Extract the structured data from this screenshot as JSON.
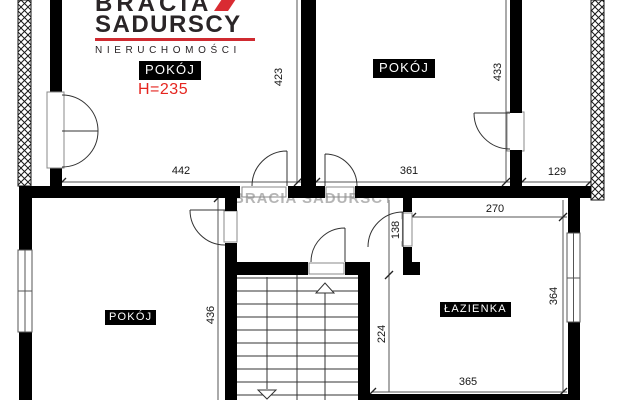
{
  "logo": {
    "line1": "BRACIA",
    "line2": "SADURSCY",
    "line3": "NIERUCHOMOŚCI",
    "roof_color": "#d92b32"
  },
  "watermark": "BRACIA SADURSCY",
  "labels": {
    "room_top_left": "POKÓJ",
    "room_top_left_height": "H=235",
    "room_top_middle": "POKÓJ",
    "room_bottom_left": "POKÓJ",
    "bathroom": "ŁAZIENKA"
  },
  "dims": {
    "d423": "423",
    "d433": "433",
    "d442": "442",
    "d361": "361",
    "d129": "129",
    "d436": "436",
    "d138": "138",
    "d270": "270",
    "d364": "364",
    "d224": "224",
    "d365": "365"
  },
  "colors": {
    "wall": "#000000",
    "accent_red": "#e5251f",
    "dim_line": "#555555",
    "watermark_grey": "#8f8f8f"
  }
}
